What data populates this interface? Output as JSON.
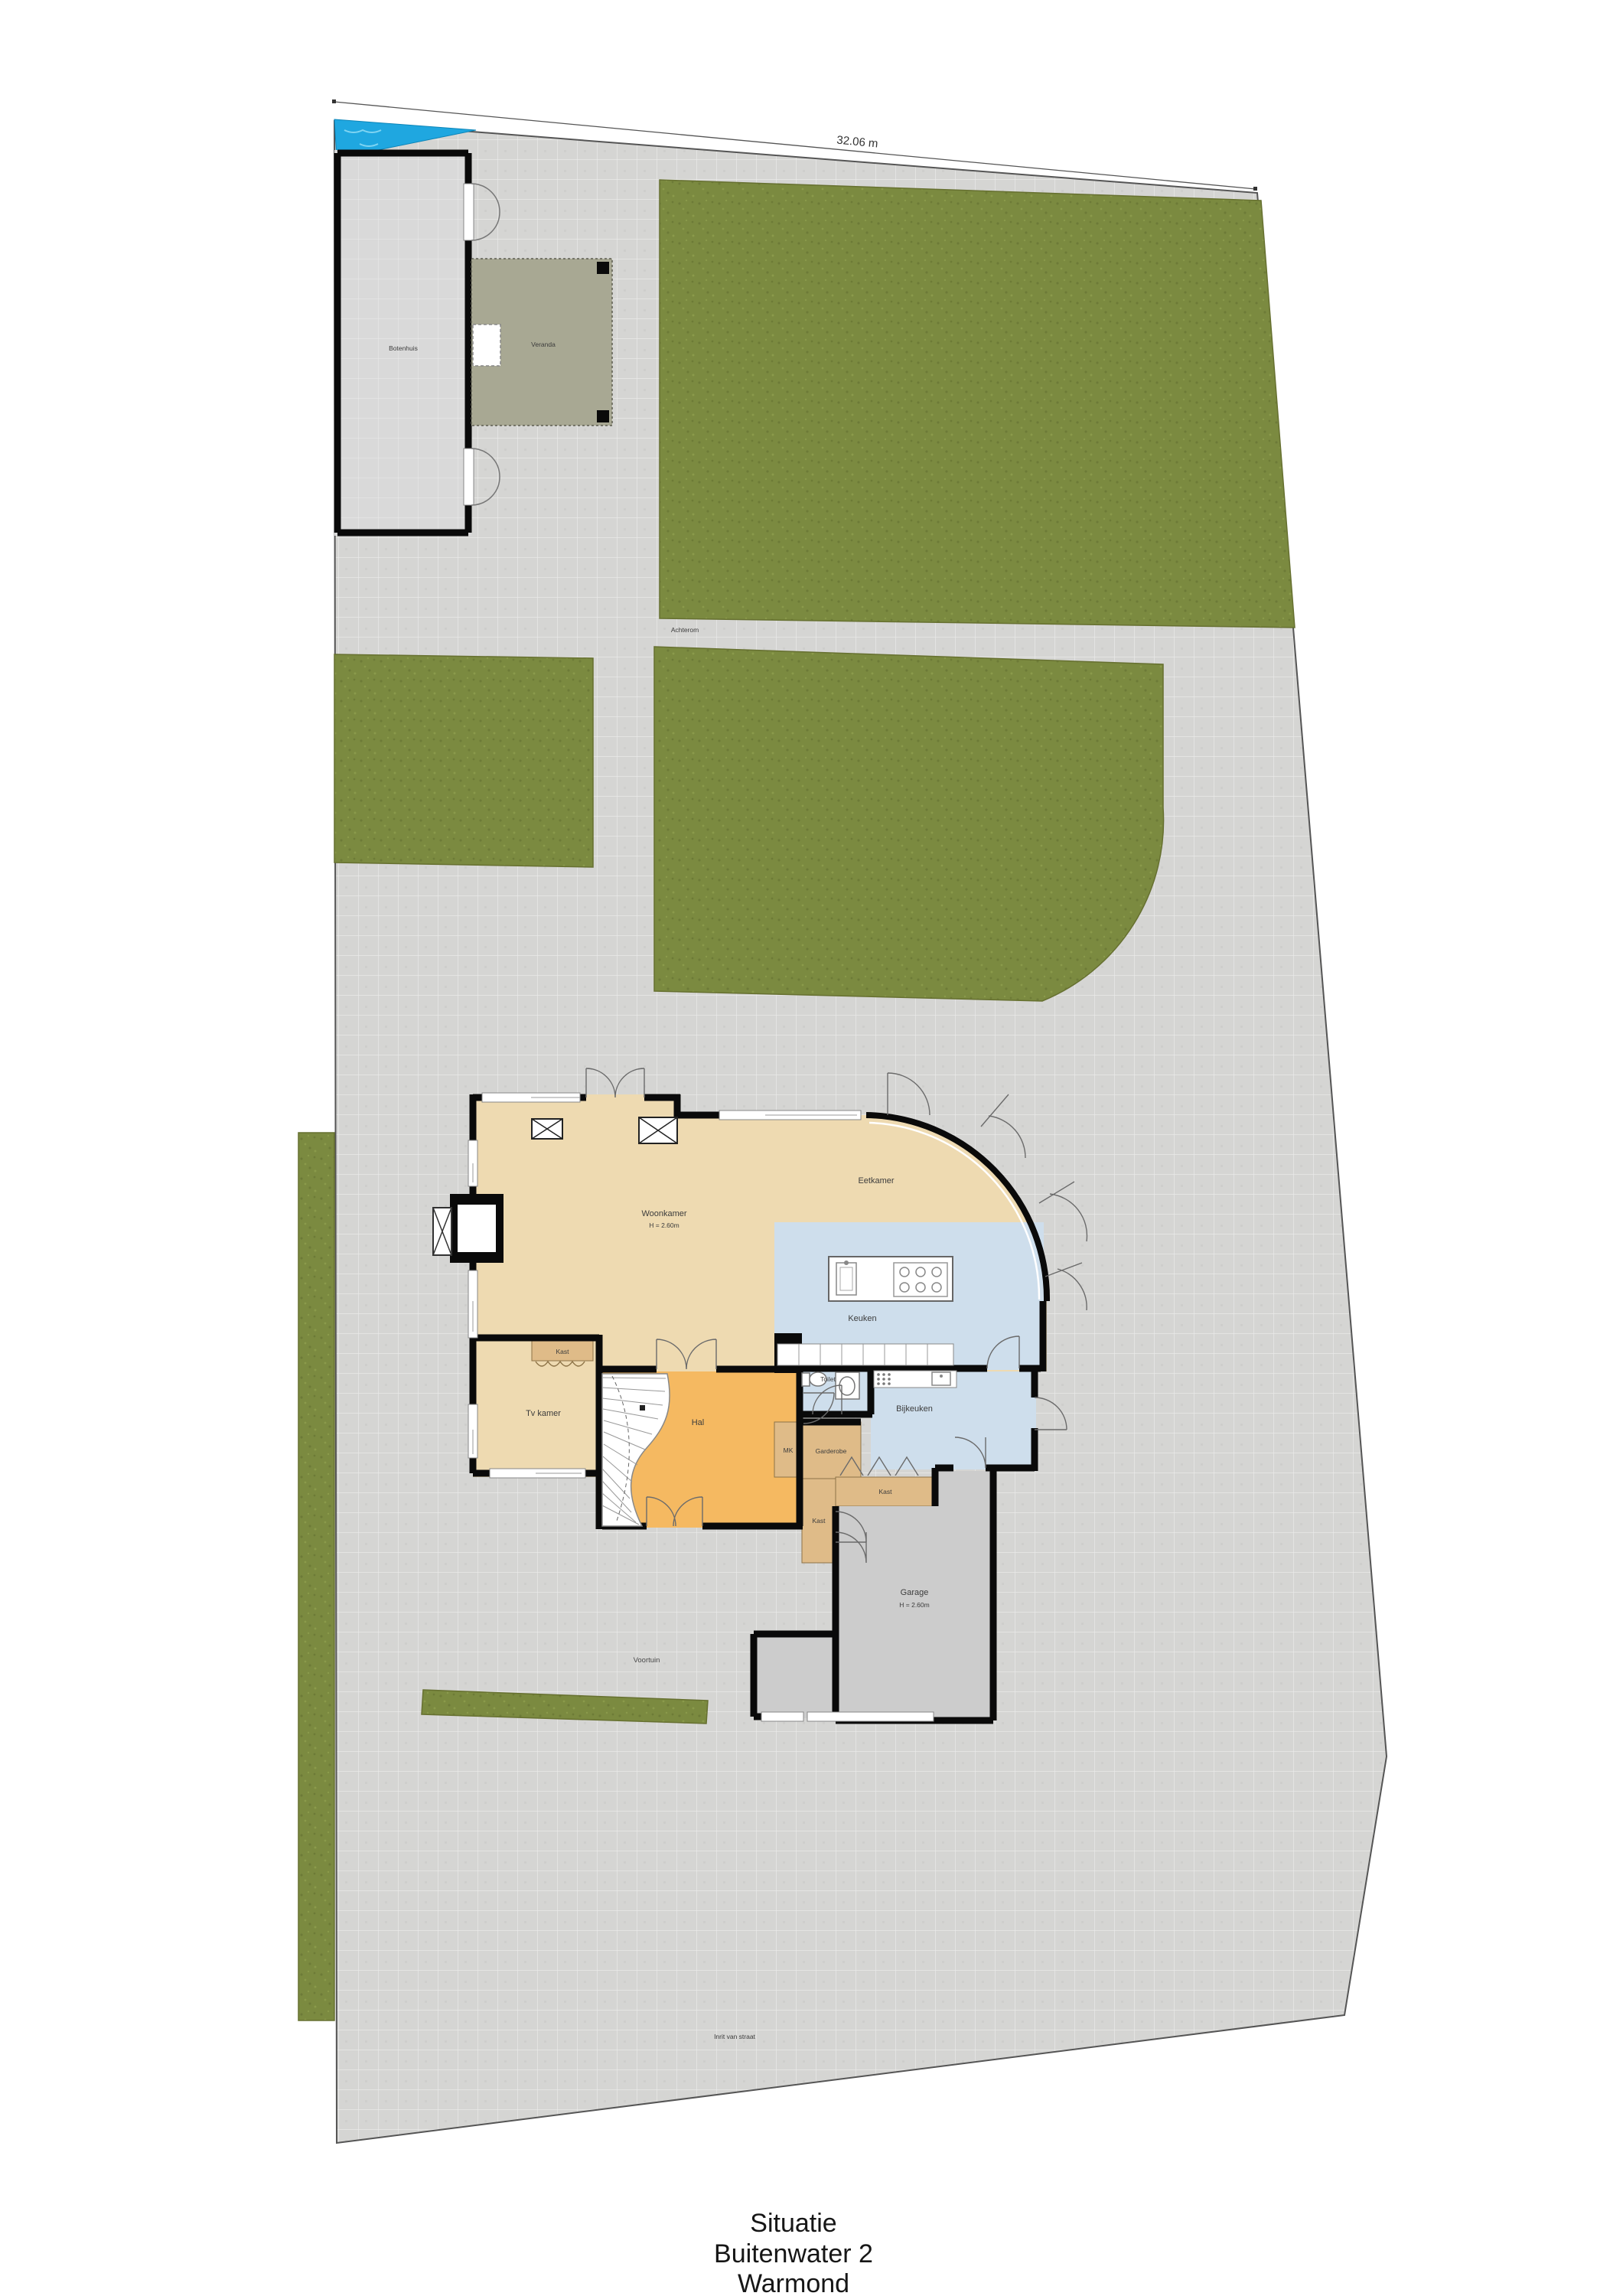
{
  "dimension": {
    "label": "32.06 m"
  },
  "outbuildings": {
    "botenhuis": "Botenhuis",
    "veranda": "Veranda"
  },
  "site": {
    "achterom": "Achterom",
    "voortuin": "Voortuin",
    "inrit": "Inrit van straat"
  },
  "house": {
    "woonkamer": "Woonkamer",
    "woonkamer_height": "H = 2.60m",
    "eetkamer": "Eetkamer",
    "keuken": "Keuken",
    "toilet": "Toilet",
    "bijkeuken": "Bijkeuken",
    "hal": "Hal",
    "tvkamer": "Tv kamer",
    "kast": "Kast",
    "garderobe": "Garderobe",
    "mk": "MK",
    "garage": "Garage",
    "garage_height": "H = 2.60m"
  },
  "title_block": {
    "line1": "Situatie",
    "line2": "Buitenwater 2",
    "line3": "Warmond"
  },
  "colors": {
    "paving": "#d5d5d3",
    "grass": "#7b8a40",
    "water": "#1fa7e0",
    "wall": "#0a0a0a",
    "room_beige": "#eedab1",
    "room_orange": "#f5b961",
    "room_blue": "#cedeec",
    "room_tan": "#dfbb88",
    "veranda_sage": "#a8a893",
    "garage_gray": "#cccccc",
    "boathouse_gray": "#d9d9d9"
  }
}
